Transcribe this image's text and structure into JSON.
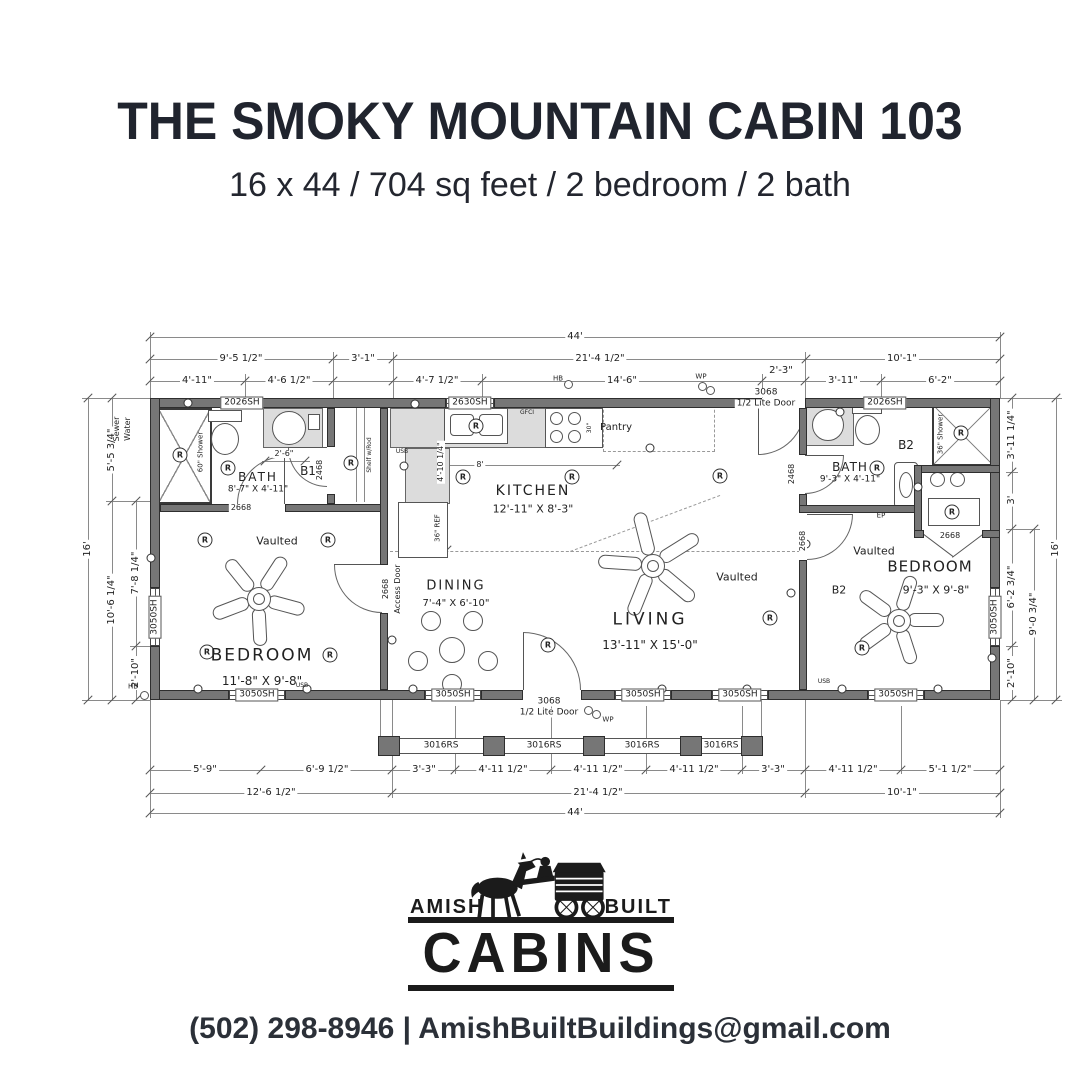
{
  "header": {
    "title": "THE SMOKY MOUNTAIN CABIN 103",
    "subtitle": "16 x 44 / 704 sq feet / 2 bedroom / 2 bath"
  },
  "logo": {
    "word_left": "AMISH",
    "word_right": "BUILT",
    "word_main": "CABINS"
  },
  "footer": {
    "text": "(502) 298-8946 | AmishBuiltBuildings@gmail.com"
  },
  "floorplan": {
    "symbols": {
      "recessed_light": "R"
    },
    "labels": [
      {
        "n": "dim",
        "t": "44'",
        "x": 575,
        "y": 337,
        "bg": 1
      },
      {
        "n": "dim",
        "t": "9'-5 1/2\"",
        "x": 241,
        "y": 359,
        "bg": 1
      },
      {
        "n": "dim",
        "t": "3'-1\"",
        "x": 363,
        "y": 359,
        "bg": 1
      },
      {
        "n": "dim",
        "t": "21'-4 1/2\"",
        "x": 600,
        "y": 359,
        "bg": 1
      },
      {
        "n": "dim",
        "t": "10'-1\"",
        "x": 902,
        "y": 359,
        "bg": 1
      },
      {
        "n": "dim",
        "t": "4'-11\"",
        "x": 197,
        "y": 381,
        "bg": 1
      },
      {
        "n": "dim",
        "t": "4'-6 1/2\"",
        "x": 289,
        "y": 381,
        "bg": 1
      },
      {
        "n": "dim",
        "t": "4'-7 1/2\"",
        "x": 437,
        "y": 381,
        "bg": 1
      },
      {
        "n": "dim",
        "t": "14'-6\"",
        "x": 622,
        "y": 381,
        "bg": 1
      },
      {
        "n": "dim",
        "t": "2'-3\"",
        "x": 781,
        "y": 371,
        "bg": 1
      },
      {
        "n": "dim",
        "t": "3'-11\"",
        "x": 843,
        "y": 381,
        "bg": 1
      },
      {
        "n": "dim",
        "t": "6'-2\"",
        "x": 940,
        "y": 381,
        "bg": 1
      },
      {
        "n": "dim",
        "t": "5'-9\"",
        "x": 205,
        "y": 770,
        "bg": 1
      },
      {
        "n": "dim",
        "t": "6'-9 1/2\"",
        "x": 327,
        "y": 770,
        "bg": 1
      },
      {
        "n": "dim",
        "t": "3'-3\"",
        "x": 424,
        "y": 770,
        "bg": 1
      },
      {
        "n": "dim",
        "t": "4'-11 1/2\"",
        "x": 503,
        "y": 770,
        "bg": 1
      },
      {
        "n": "dim",
        "t": "4'-11 1/2\"",
        "x": 598,
        "y": 770,
        "bg": 1
      },
      {
        "n": "dim",
        "t": "4'-11 1/2\"",
        "x": 694,
        "y": 770,
        "bg": 1
      },
      {
        "n": "dim",
        "t": "3'-3\"",
        "x": 773,
        "y": 770,
        "bg": 1
      },
      {
        "n": "dim",
        "t": "4'-11 1/2\"",
        "x": 853,
        "y": 770,
        "bg": 1
      },
      {
        "n": "dim",
        "t": "5'-1 1/2\"",
        "x": 950,
        "y": 770,
        "bg": 1
      },
      {
        "n": "dim",
        "t": "12'-6 1/2\"",
        "x": 271,
        "y": 793,
        "bg": 1
      },
      {
        "n": "dim",
        "t": "21'-4 1/2\"",
        "x": 598,
        "y": 793,
        "bg": 1
      },
      {
        "n": "dim",
        "t": "10'-1\"",
        "x": 902,
        "y": 793,
        "bg": 1
      },
      {
        "n": "dim",
        "t": "44'",
        "x": 575,
        "y": 813,
        "bg": 1
      },
      {
        "n": "dim",
        "t": "16'",
        "x": 88,
        "y": 549,
        "r": -90,
        "bg": 1
      },
      {
        "n": "dim",
        "t": "5'-5 3/4\"",
        "x": 112,
        "y": 450,
        "r": -90,
        "bg": 1
      },
      {
        "n": "dim",
        "t": "10'-6 1/4\"",
        "x": 112,
        "y": 600,
        "r": -90,
        "bg": 1
      },
      {
        "n": "dim",
        "t": "7'-8 1/4\"",
        "x": 136,
        "y": 573,
        "r": -90,
        "bg": 1
      },
      {
        "n": "dim",
        "t": "2'-10\"",
        "x": 136,
        "y": 673,
        "r": -90,
        "bg": 1
      },
      {
        "n": "dim",
        "t": "3'-11 1/4\"",
        "x": 1012,
        "y": 435,
        "r": -90,
        "bg": 1
      },
      {
        "n": "dim",
        "t": "3'",
        "x": 1012,
        "y": 500,
        "r": -90,
        "bg": 1
      },
      {
        "n": "dim",
        "t": "6'-2 3/4\"",
        "x": 1012,
        "y": 587,
        "r": -90,
        "bg": 1
      },
      {
        "n": "dim",
        "t": "2'-10\"",
        "x": 1012,
        "y": 673,
        "r": -90,
        "bg": 1
      },
      {
        "n": "dim",
        "t": "9'-0 3/4\"",
        "x": 1034,
        "y": 614,
        "r": -90,
        "bg": 1
      },
      {
        "n": "dim",
        "t": "16'",
        "x": 1056,
        "y": 549,
        "r": -90,
        "bg": 1
      },
      {
        "n": "note",
        "t": "Sewer",
        "x": 117,
        "y": 429,
        "r": -90,
        "s": 8
      },
      {
        "n": "note",
        "t": "Water",
        "x": 128,
        "y": 429,
        "r": -90,
        "s": 8
      },
      {
        "n": "window",
        "t": "2026SH",
        "x": 242,
        "y": 403,
        "bx": 1,
        "s": 9
      },
      {
        "n": "window",
        "t": "2630SH",
        "x": 470,
        "y": 403,
        "bx": 1,
        "s": 9
      },
      {
        "n": "window",
        "t": "2026SH",
        "x": 885,
        "y": 403,
        "bx": 1,
        "s": 9
      },
      {
        "n": "window",
        "t": "3050SH",
        "x": 257,
        "y": 695,
        "bx": 1,
        "s": 9
      },
      {
        "n": "window",
        "t": "3050SH",
        "x": 453,
        "y": 695,
        "bx": 1,
        "s": 9
      },
      {
        "n": "window",
        "t": "3050SH",
        "x": 643,
        "y": 695,
        "bx": 1,
        "s": 9
      },
      {
        "n": "window",
        "t": "3050SH",
        "x": 740,
        "y": 695,
        "bx": 1,
        "s": 9
      },
      {
        "n": "window",
        "t": "3050SH",
        "x": 896,
        "y": 695,
        "bx": 1,
        "s": 9
      },
      {
        "n": "window",
        "t": "3050SH",
        "x": 155,
        "y": 617,
        "r": -90,
        "bx": 1,
        "s": 9
      },
      {
        "n": "window",
        "t": "3050SH",
        "x": 995,
        "y": 617,
        "r": -90,
        "bx": 1,
        "s": 9
      },
      {
        "n": "railing",
        "t": "3016RS",
        "x": 441,
        "y": 746,
        "s": 9
      },
      {
        "n": "railing",
        "t": "3016RS",
        "x": 544,
        "y": 746,
        "s": 9
      },
      {
        "n": "railing",
        "t": "3016RS",
        "x": 642,
        "y": 746,
        "s": 9
      },
      {
        "n": "railing",
        "t": "3016RS",
        "x": 721,
        "y": 746,
        "s": 9
      },
      {
        "n": "door",
        "t": "3068",
        "x": 766,
        "y": 393,
        "bg": 1,
        "s": 9
      },
      {
        "n": "door",
        "t": "1/2 Lite Door",
        "x": 766,
        "y": 404,
        "bg": 1,
        "s": 9
      },
      {
        "n": "door",
        "t": "3068",
        "x": 549,
        "y": 702,
        "bg": 1,
        "s": 9
      },
      {
        "n": "door",
        "t": "1/2 Lite Door",
        "x": 549,
        "y": 713,
        "bg": 1,
        "s": 9
      },
      {
        "n": "door",
        "t": "2468",
        "x": 320,
        "y": 470,
        "r": -90,
        "s": 8,
        "bg": 1
      },
      {
        "n": "door",
        "t": "2468",
        "x": 792,
        "y": 474,
        "r": -90,
        "s": 8,
        "bg": 1
      },
      {
        "n": "door",
        "t": "2668",
        "x": 241,
        "y": 508,
        "bg": 1,
        "s": 8
      },
      {
        "n": "door",
        "t": "2668",
        "x": 386,
        "y": 589,
        "r": -90,
        "s": 8,
        "bg": 1
      },
      {
        "n": "door",
        "t": "Access Door",
        "x": 398,
        "y": 589,
        "r": -90,
        "s": 8,
        "bg": 1
      },
      {
        "n": "door",
        "t": "2668",
        "x": 803,
        "y": 541,
        "r": -90,
        "s": 8,
        "bg": 1
      },
      {
        "n": "door",
        "t": "2668",
        "x": 950,
        "y": 536,
        "bg": 1,
        "s": 8
      },
      {
        "n": "room",
        "t": "BATH",
        "x": 258,
        "y": 477,
        "s": 12,
        "ls": 2
      },
      {
        "n": "room-size",
        "t": "8'-7\" X 4'-11\"",
        "x": 258,
        "y": 490,
        "s": 9
      },
      {
        "n": "room",
        "t": "B1",
        "x": 308,
        "y": 471,
        "s": 12
      },
      {
        "n": "room",
        "t": "KITCHEN",
        "x": 533,
        "y": 491,
        "s": 14,
        "ls": 2
      },
      {
        "n": "room-size",
        "t": "12'-11\" X 8'-3\"",
        "x": 533,
        "y": 509,
        "s": 11
      },
      {
        "n": "note",
        "t": "Pantry",
        "x": 616,
        "y": 428,
        "s": 10
      },
      {
        "n": "room",
        "t": "DINING",
        "x": 456,
        "y": 586,
        "s": 13,
        "ls": 2
      },
      {
        "n": "room-size",
        "t": "7'-4\" X 6'-10\"",
        "x": 456,
        "y": 604,
        "s": 10
      },
      {
        "n": "room",
        "t": "LIVING",
        "x": 650,
        "y": 620,
        "s": 17,
        "ls": 3
      },
      {
        "n": "room-size",
        "t": "13'-11\" X 15'-0\"",
        "x": 650,
        "y": 645,
        "s": 12
      },
      {
        "n": "room",
        "t": "BEDROOM",
        "x": 262,
        "y": 656,
        "s": 17,
        "ls": 2
      },
      {
        "n": "room-size",
        "t": "11'-8\" X 9'-8\"",
        "x": 262,
        "y": 681,
        "s": 12
      },
      {
        "n": "room",
        "t": "BEDROOM",
        "x": 930,
        "y": 567,
        "s": 15,
        "ls": 1
      },
      {
        "n": "room-size",
        "t": "9'-3\" X 9'-8\"",
        "x": 936,
        "y": 590,
        "s": 11
      },
      {
        "n": "room",
        "t": "BATH",
        "x": 850,
        "y": 467,
        "s": 12,
        "ls": 1
      },
      {
        "n": "room-size",
        "t": "9'-3\" X 4'-11\"",
        "x": 850,
        "y": 480,
        "s": 9
      },
      {
        "n": "room",
        "t": "B2",
        "x": 906,
        "y": 445,
        "s": 12
      },
      {
        "n": "room",
        "t": "B2",
        "x": 839,
        "y": 590,
        "s": 11
      },
      {
        "n": "note",
        "t": "Vaulted",
        "x": 277,
        "y": 541,
        "s": 11
      },
      {
        "n": "note",
        "t": "Vaulted",
        "x": 737,
        "y": 577,
        "s": 11
      },
      {
        "n": "note",
        "t": "Vaulted",
        "x": 874,
        "y": 551,
        "s": 11
      },
      {
        "n": "dim",
        "t": "2'-6\"",
        "x": 284,
        "y": 454,
        "s": 8,
        "bg": 1
      },
      {
        "n": "dim",
        "t": "8'",
        "x": 480,
        "y": 465,
        "s": 8,
        "bg": 1
      },
      {
        "n": "dim",
        "t": "4'-10 1/4\"",
        "x": 441,
        "y": 462,
        "r": -90,
        "s": 8,
        "bg": 1
      },
      {
        "n": "note",
        "t": "36\" REF",
        "x": 438,
        "y": 528,
        "r": -90,
        "s": 7
      },
      {
        "n": "note",
        "t": "60\" Shower",
        "x": 201,
        "y": 452,
        "r": -90,
        "s": 7
      },
      {
        "n": "note",
        "t": "36\" Shower",
        "x": 941,
        "y": 434,
        "r": -90,
        "s": 7
      },
      {
        "n": "note",
        "t": "Shelf w/Rod",
        "x": 370,
        "y": 455,
        "r": -90,
        "s": 6
      },
      {
        "n": "note",
        "t": "GFCI",
        "x": 527,
        "y": 413,
        "s": 6
      },
      {
        "n": "note",
        "t": "30\"",
        "x": 590,
        "y": 428,
        "r": -90,
        "s": 6
      },
      {
        "n": "note",
        "t": "USB",
        "x": 402,
        "y": 452,
        "s": 6
      },
      {
        "n": "note",
        "t": "USB",
        "x": 302,
        "y": 686,
        "s": 6
      },
      {
        "n": "note",
        "t": "USB",
        "x": 824,
        "y": 682,
        "s": 6
      },
      {
        "n": "note",
        "t": "HB",
        "x": 558,
        "y": 379,
        "s": 7
      },
      {
        "n": "note",
        "t": "HB",
        "x": 133,
        "y": 687,
        "s": 7
      },
      {
        "n": "note",
        "t": "WP",
        "x": 701,
        "y": 377,
        "s": 7
      },
      {
        "n": "note",
        "t": "WP",
        "x": 608,
        "y": 720,
        "s": 7
      },
      {
        "n": "note",
        "t": "EP",
        "x": 881,
        "y": 516,
        "s": 7
      }
    ]
  }
}
